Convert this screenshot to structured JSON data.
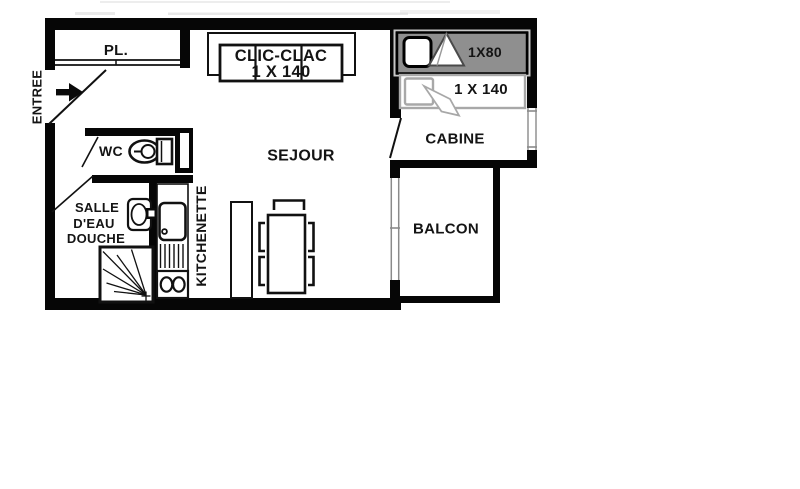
{
  "colors": {
    "wall": "#060606",
    "line": "#1a1a1a",
    "text": "#141414",
    "banner_fill": "#8f8f8f",
    "banner_frame": "#c6c6c6",
    "bed_outline": "#a8a8a8",
    "window_line": "#8a8a8a"
  },
  "labels": {
    "entree": "ENTREE",
    "placard": "PL.",
    "wc": "WC",
    "salle_deau_1": "SALLE",
    "salle_deau_2": "D'EAU",
    "salle_deau_3": "DOUCHE",
    "kitchenette": "KITCHENETTE",
    "sejour": "SEJOUR",
    "cabine": "CABINE",
    "balcon": "BALCON"
  },
  "furniture": {
    "sofa_label_1": "CLIC-CLAC",
    "sofa_label_2": "1 X 140",
    "bunk_label": "1X80",
    "cabine_bed_label": "1 X 140"
  }
}
